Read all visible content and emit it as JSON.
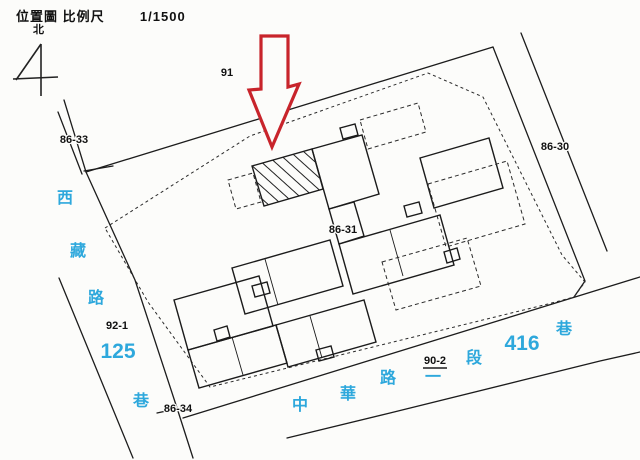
{
  "header": {
    "title_label": "位置圖",
    "scale_label": "比例尺",
    "scale_value": "1/1500"
  },
  "north": {
    "label": "北"
  },
  "map": {
    "colors": {
      "line": "#1c1c1c",
      "street_name": "#2ea8dc",
      "arrow": "#c8242b",
      "background": "#fcfcfa"
    },
    "parcel_labels": [
      {
        "id": "91",
        "x": 227,
        "y": 72,
        "underlined": false
      },
      {
        "id": "86-33",
        "x": 74,
        "y": 139,
        "underlined": false
      },
      {
        "id": "86-30",
        "x": 555,
        "y": 146,
        "underlined": false
      },
      {
        "id": "86-31",
        "x": 343,
        "y": 229,
        "underlined": false
      },
      {
        "id": "92-1",
        "x": 117,
        "y": 325,
        "underlined": false
      },
      {
        "id": "86-34",
        "x": 178,
        "y": 408,
        "underlined": false
      },
      {
        "id": "90-2",
        "x": 435,
        "y": 360,
        "underlined": true
      }
    ],
    "streets": [
      {
        "name": "西藏路125巷",
        "chars": [
          {
            "t": "西",
            "x": 65,
            "y": 197,
            "size": 16
          },
          {
            "t": "藏",
            "x": 78,
            "y": 250,
            "size": 16
          },
          {
            "t": "路",
            "x": 96,
            "y": 297,
            "size": 16
          },
          {
            "t": "125",
            "x": 118,
            "y": 350,
            "size": 21
          },
          {
            "t": "巷",
            "x": 141,
            "y": 400,
            "size": 16
          }
        ]
      },
      {
        "name": "中華路一段416巷",
        "chars": [
          {
            "t": "中",
            "x": 300,
            "y": 404,
            "size": 16
          },
          {
            "t": "華",
            "x": 348,
            "y": 393,
            "size": 16
          },
          {
            "t": "路",
            "x": 388,
            "y": 377,
            "size": 16
          },
          {
            "t": "一",
            "x": 433,
            "y": 376,
            "size": 16
          },
          {
            "t": "段",
            "x": 474,
            "y": 357,
            "size": 16
          },
          {
            "t": "416",
            "x": 522,
            "y": 342,
            "size": 21
          },
          {
            "t": "巷",
            "x": 564,
            "y": 328,
            "size": 16
          }
        ]
      }
    ]
  }
}
